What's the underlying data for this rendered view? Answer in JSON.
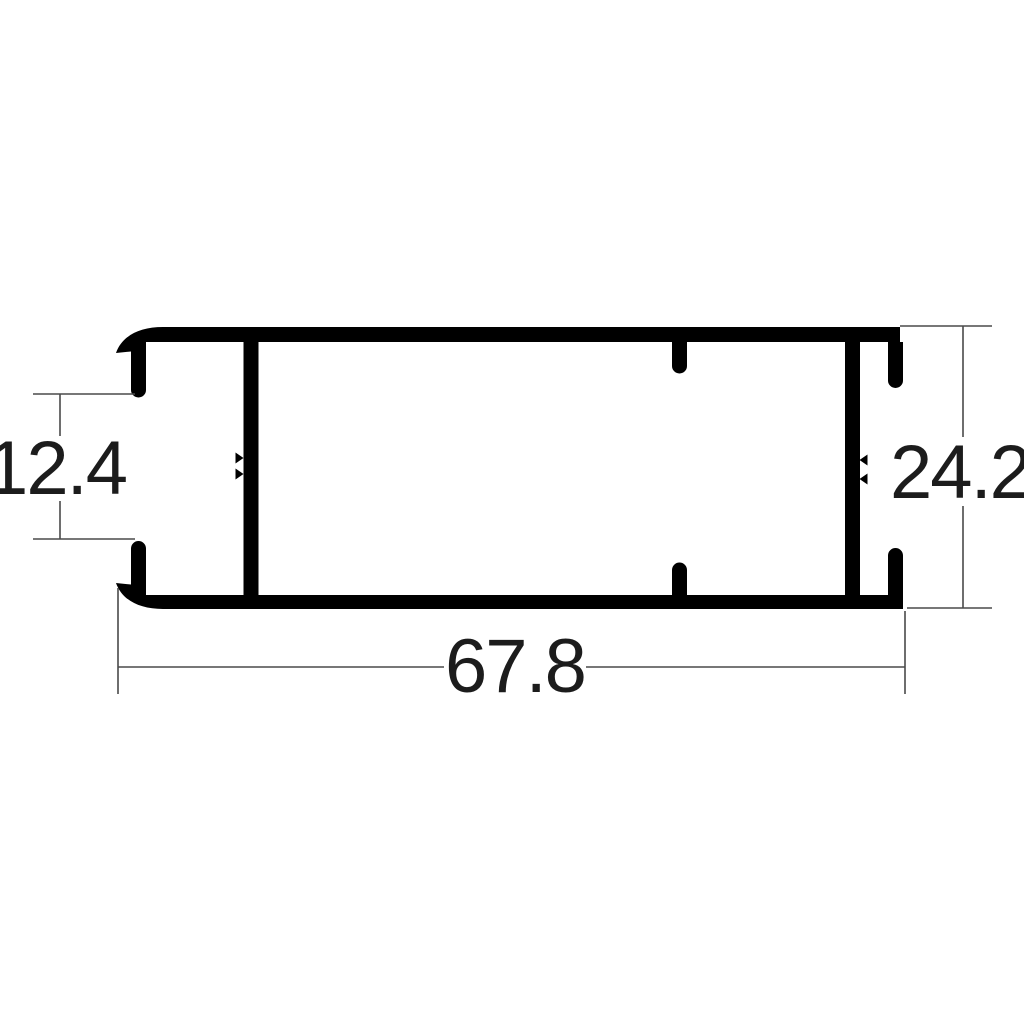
{
  "drawing": {
    "title": "aluminium-profile-cross-section",
    "background_color": "#ffffff",
    "profile_color": "#000000",
    "dimension_line_color": "#4a4a4a",
    "dimension_text_color": "#1c1c1c",
    "dimensions": [
      {
        "id": "left-opening-height",
        "label": "12.4",
        "orientation": "vertical",
        "position": "left"
      },
      {
        "id": "overall-height",
        "label": "24.2",
        "orientation": "vertical",
        "position": "right"
      },
      {
        "id": "overall-width",
        "label": "67.8",
        "orientation": "horizontal",
        "position": "bottom"
      }
    ]
  }
}
